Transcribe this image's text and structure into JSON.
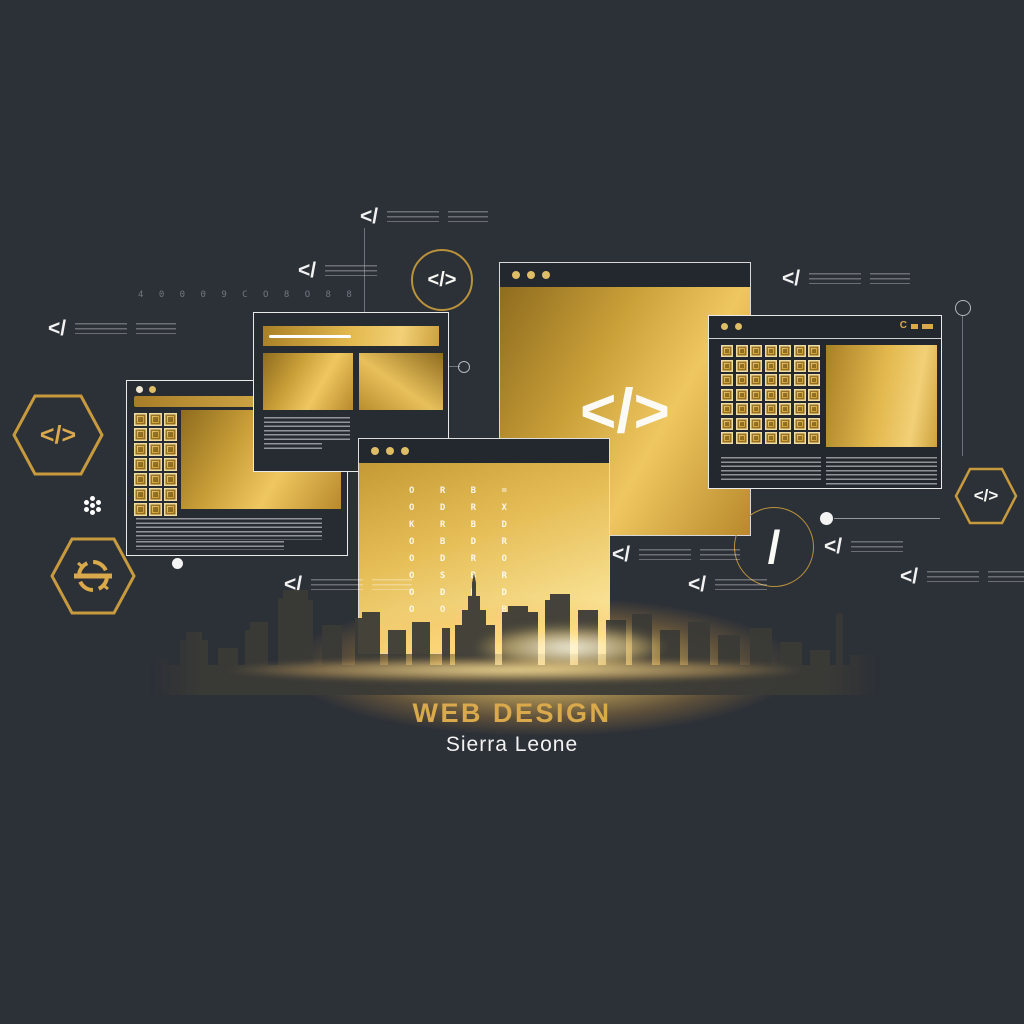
{
  "poster": {
    "heading": "WEB DESIGN",
    "subheading": "Sierra Leone"
  },
  "glyphs": {
    "code_tag": "</>",
    "slash": "/",
    "close_tag": "</",
    "glyph_strip": "4 0 0 0 9 C O 8 O 8 8",
    "titlebar_c_icon": "C"
  },
  "code_grid": {
    "rows": [
      "O R B =",
      "O D R X",
      "K R B D",
      "O B D R",
      "O D R O",
      "O S B R",
      "O D B D",
      "O O B B"
    ]
  },
  "grids": {
    "right_window": {
      "rows": 7,
      "cols": 7
    },
    "left_window": {
      "rows": 7,
      "cols": 3
    }
  },
  "colors": {
    "background": "#2C3037",
    "gold": "#D9A94C",
    "gold_deep": "#8F6C20",
    "panel_dark": "#23272E",
    "outline_white": "#EDEDED"
  }
}
